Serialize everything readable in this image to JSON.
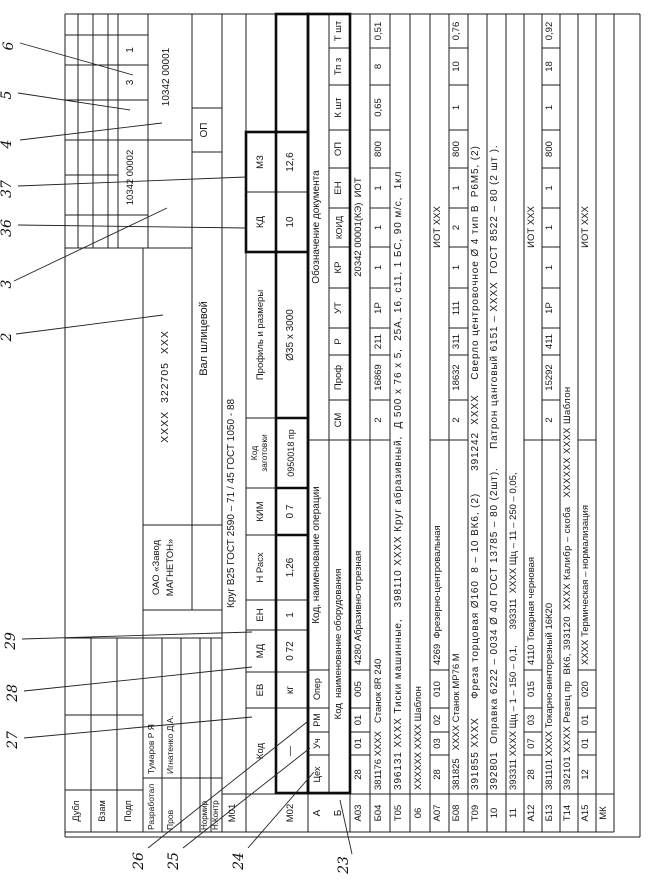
{
  "callouts": {
    "c2": "2",
    "c3": "3",
    "c4": "4",
    "c5": "5",
    "c6": "6",
    "c23": "23",
    "c24": "24",
    "c25": "25",
    "c26": "26",
    "c27": "27",
    "c28": "28",
    "c29": "29",
    "c36": "36",
    "c37": "37"
  },
  "stamp": {
    "dubl": "Дубл",
    "vzam": "Взам",
    "podp": "Подп",
    "razrab_label": "Разработал",
    "razrab_name": "Тумаров Р Я",
    "prov_label": "Пров",
    "prov_name": "Игнатенко Д.А.",
    "normir_label": "Нормир",
    "nkontr_label": "Н.Контр"
  },
  "header": {
    "org_line1": "ОАО «Завод",
    "org_line2": "МАГНЕТОН»",
    "part_designation": "ХХХХ  322705  ХХХ",
    "part_name": "Вал шлицевой",
    "doc_no_1": "10342 00001",
    "doc_no_2": "10342 00002",
    "sheet_total": "3",
    "sheet_no": "1",
    "op_code": "ОП"
  },
  "m01": {
    "label": "М01",
    "material": "Круг В25 ГОСТ 2590 – 71 / 45 ГОСТ 1050 - 88"
  },
  "m02": {
    "label": "М02",
    "h_kod": "Код",
    "h_ev": "ЕВ",
    "h_md": "МД",
    "h_en": "ЕН",
    "h_nrasx": "Н Расх",
    "h_kim": "КИМ",
    "h_kodzag_1": "Код",
    "h_kodzag_2": "заготовки",
    "h_profil": "Профиль и размеры",
    "h_kd": "КД",
    "h_mz": "МЗ",
    "v_kod": "—",
    "v_ev": "кг",
    "v_md": "0 72",
    "v_en": "1",
    "v_nrasx": "1,26",
    "v_kim": "0 7",
    "v_kodzag": "0950018 пр",
    "v_profil": "Ø35 х 3000",
    "v_kd": "10",
    "v_mz": "12,6"
  },
  "table": {
    "a": "А",
    "b": "Б",
    "cex": "Цех",
    "uch": "Уч",
    "rm": "РМ",
    "oper": "Опер",
    "op_name": "Код, наименование операции",
    "doc_ref": "Обозначение документа",
    "equip": "Код  наименование оборудования",
    "sm": "СМ",
    "prof": "Проф",
    "r": "Р",
    "ut": "УТ",
    "kr": "КР",
    "koid": "КОИД",
    "en": "ЕН",
    "op": "ОП",
    "k_sht": "К шт",
    "tp_z": "Тп з",
    "t_sht": "Т шт"
  },
  "rows": [
    {
      "label": "А03",
      "cex": "28",
      "uch": "01",
      "rm": "01",
      "oper": "005",
      "name": "4280 Абразивно-отрезная",
      "doc": "20342 00001(КЭ)  ИОТ"
    },
    {
      "label": "Б04",
      "text": "381176 ХХХХ   Станок 8R 240",
      "sm": "2",
      "prof": "16869",
      "r": "211",
      "ut": "1Р",
      "kr": "1",
      "koid": "1",
      "en": "1",
      "op": "800",
      "k_sht": "0,65",
      "tp_z": "8",
      "t_sht": "0,51"
    },
    {
      "label": "Т05",
      "text": "396131 ХХХХ Тиски машинные,   398110 ХХХХ Круг абразивный,  Д 500 х 76 х 5,  25А, 16, с11, 1 БС, 90 м/с,  1кл"
    },
    {
      "label": "06",
      "text": "ХХХХХХ ХХХХ Шаблон"
    },
    {
      "label": "А07",
      "cex": "28",
      "uch": "03",
      "rm": "02",
      "oper": "010",
      "name": "4269  Фрезерно-центровальная",
      "doc": "ИОТ ХХХ"
    },
    {
      "label": "Б08",
      "text": "381825   ХХХХ Станок МР76 М",
      "sm": "2",
      "prof": "18632",
      "r": "311",
      "ut": "111",
      "kr": "1",
      "koid": "2",
      "en": "1",
      "op": "800",
      "k_sht": "1",
      "tp_z": "10",
      "t_sht": "0,76"
    },
    {
      "label": "Т09",
      "text": "391855 ХХХХ     Фреза торцовая Ø160  8 – 10 ВК6, (2)      391242  ХХХХ    Сверло центровочное Ø 4 тип В  Р6М5, (2)"
    },
    {
      "label": "10",
      "text": "392801  Оправка 6222 – 0034 Ø 40 ГОСТ 13785 – 80 (2шт).     Патрон цанговый 6151 – ХХХХ  ГОСТ 8522 – 80 (2 шт )."
    },
    {
      "label": "11",
      "text": "393311 ХХХХ Щц – 1 – 150 – 0,1,      393311  ХХХХ Щц – 11 – 250 – 0,05,"
    },
    {
      "label": "А12",
      "cex": "28",
      "uch": "07",
      "rm": "03",
      "oper": "015",
      "name": "4110 Токарная черновая",
      "doc": "ИОТ ХХХ"
    },
    {
      "label": "Б13",
      "text": "381101 ХХХХ Токарно-винторезный 16К20",
      "sm": "2",
      "prof": "15292",
      "r": "411",
      "ut": "1Р",
      "kr": "1",
      "koid": "1",
      "en": "1",
      "op": "800",
      "k_sht": "1",
      "tp_z": "18",
      "t_sht": "0,92"
    },
    {
      "label": "Т14",
      "text": "392101 ХХХХ Резец пр  ВК6, 393120  ХХХХ Калибр – скоба   ХХХХХХ ХХХХ Шаблон"
    },
    {
      "label": "А15",
      "cex": "12",
      "uch": "01",
      "rm": "01",
      "oper": "020",
      "name": "ХХХХ Термическая – нормализация",
      "doc": "ИОТ ХХХ"
    },
    {
      "label": "МК",
      "text": ""
    }
  ]
}
